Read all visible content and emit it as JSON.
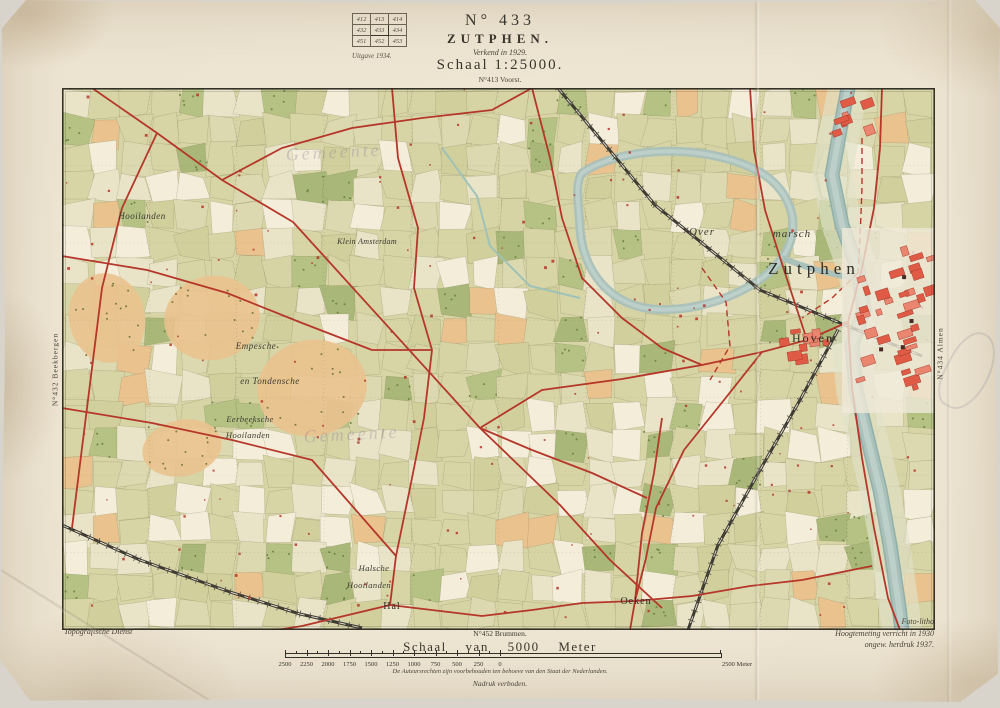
{
  "index_grid": {
    "rows": [
      [
        "412",
        "413",
        "414"
      ],
      [
        "432",
        "433",
        "434"
      ],
      [
        "451",
        "452",
        "453"
      ]
    ],
    "highlight": "433",
    "edition_label": "Uitgave 1934."
  },
  "title_block": {
    "sheet_number": "N° 433",
    "sheet_name": "ZUTPHEN.",
    "surveyed_note": "Verkend in 1929.",
    "scale_label": "Schaal 1:25000.",
    "adjacent_north": "N°413 Voorst."
  },
  "edge_labels": {
    "left_sheet": "N°432 Beekbergen",
    "right_sheet": "N°434 Almen",
    "bottom_sheet": "N°452 Brummen."
  },
  "footer": {
    "agency": "Topografische Dienst",
    "scalebar_title": "Schaal van 5000 Meter",
    "scalebar_ticks": [
      "2500",
      "2250",
      "2000",
      "1750",
      "1500",
      "1250",
      "1000",
      "750",
      "500",
      "250",
      "0"
    ],
    "scalebar_end_label": "2500 Meter",
    "copyright_line": "De Auteursrechten zijn voorbehouden ten behoeve van den Staat der Nederlanden.",
    "forbidden_line": "Nadruk verboden.",
    "litho_note": "Foto-litho",
    "survey_note": "Hoogtemeting verricht in 1930",
    "reprint_note": "ongew. herdruk 1937."
  },
  "map": {
    "colors": {
      "base": "#d7d4a6",
      "field_light": "#e9e4c8",
      "field_white": "#f3edda",
      "wood": "#b5c283",
      "wood_dark": "#a9b878",
      "heath_orange": "#eac28e",
      "water": "#a9c0bb",
      "water_light": "#bccfc8",
      "water_edge": "#8fafa9",
      "road_red": "#b5372a",
      "city_red": "#df5b45",
      "city_red_light": "#ea8570",
      "rail_dark": "#3e3b33",
      "label_ink": "#2f2d26",
      "stamp_purple": "#8a6f92"
    },
    "labels": [
      {
        "text": "Zutphen",
        "x": 752,
        "y": 186,
        "size": 17,
        "ls": 5,
        "cls": "town"
      },
      {
        "text": "Hoven",
        "x": 751,
        "y": 254,
        "size": 12,
        "ls": 2,
        "cls": "town"
      },
      {
        "text": "Over",
        "x": 640,
        "y": 147,
        "size": 11,
        "ls": 1,
        "cls": "area"
      },
      {
        "text": "marsch",
        "x": 730,
        "y": 149,
        "size": 11,
        "ls": 1,
        "cls": "area"
      },
      {
        "text": "Hooilanden",
        "x": 80,
        "y": 131,
        "size": 9,
        "ls": 0.5,
        "cls": "area"
      },
      {
        "text": "Empesche",
        "x": 194,
        "y": 261,
        "size": 9,
        "ls": 0.5,
        "cls": "area"
      },
      {
        "text": "en Tondensche",
        "x": 208,
        "y": 296,
        "size": 9,
        "ls": 0.5,
        "cls": "area"
      },
      {
        "text": "Eerbeeksche",
        "x": 188,
        "y": 334,
        "size": 8.5,
        "ls": 0.4,
        "cls": "area"
      },
      {
        "text": "Hooilanden",
        "x": 186,
        "y": 350,
        "size": 8.5,
        "ls": 0.4,
        "cls": "area"
      },
      {
        "text": "Klein Amsterdam",
        "x": 305,
        "y": 156,
        "size": 8,
        "ls": 0.3,
        "cls": "area"
      },
      {
        "text": "Halsche",
        "x": 312,
        "y": 483,
        "size": 8.5,
        "ls": 0.4,
        "cls": "area"
      },
      {
        "text": "Hooilanden",
        "x": 307,
        "y": 500,
        "size": 8.5,
        "ls": 0.4,
        "cls": "area"
      },
      {
        "text": "Hal",
        "x": 330,
        "y": 521,
        "size": 10,
        "ls": 1,
        "cls": "town"
      },
      {
        "text": "Oeken",
        "x": 574,
        "y": 516,
        "size": 10,
        "ls": 1,
        "cls": "town"
      },
      {
        "text": "Gemeente",
        "x": 272,
        "y": 70,
        "size": 18,
        "ls": 3,
        "cls": "stamp",
        "rot": -3
      },
      {
        "text": "Gemeente",
        "x": 290,
        "y": 352,
        "size": 18,
        "ls": 3,
        "cls": "stamp",
        "rot": -3
      }
    ]
  }
}
